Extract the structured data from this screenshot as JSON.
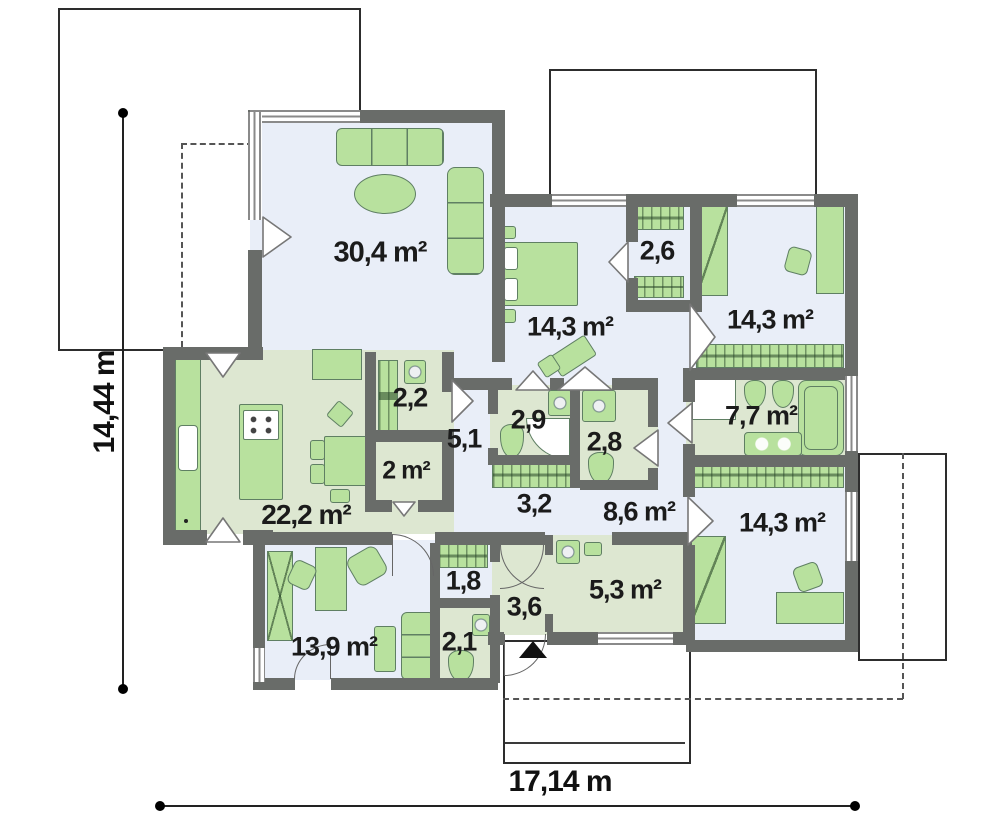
{
  "plan_title": "single-storey-house-floor-plan",
  "dimensions": {
    "horizontal": "17,14 m",
    "vertical": "14,44 m"
  },
  "rooms": [
    {
      "id": "living-room",
      "area": "30,4 m²"
    },
    {
      "id": "bedroom-top-left",
      "area": "14,3 m²"
    },
    {
      "id": "wardrobe-top",
      "area": "2,6"
    },
    {
      "id": "bedroom-top-right",
      "area": "14,3 m²"
    },
    {
      "id": "pantry",
      "area": "2,2"
    },
    {
      "id": "hall-51",
      "area": "5,1"
    },
    {
      "id": "closet-2m",
      "area": "2 m²"
    },
    {
      "id": "bathroom-29",
      "area": "2,9"
    },
    {
      "id": "wc-28",
      "area": "2,8"
    },
    {
      "id": "hall-32",
      "area": "3,2"
    },
    {
      "id": "hall-86",
      "area": "8,6 m²"
    },
    {
      "id": "bathroom-77",
      "area": "7,7 m²"
    },
    {
      "id": "kitchen-dining",
      "area": "22,2 m²"
    },
    {
      "id": "bedroom-bottom-right",
      "area": "14,3 m²"
    },
    {
      "id": "closet-18",
      "area": "1,8"
    },
    {
      "id": "vestibule-36",
      "area": "3,6"
    },
    {
      "id": "entry-hall-53",
      "area": "5,3 m²"
    },
    {
      "id": "office-bedroom",
      "area": "13,9 m²"
    },
    {
      "id": "wc-21",
      "area": "2,1"
    }
  ],
  "colors": {
    "wall": "#696c69",
    "room_floor": "#e9eef8",
    "service_floor": "#dde7d1",
    "furniture": "#b8e19e",
    "furniture_outline": "#5f7f63",
    "text": "#1b1b1b"
  }
}
